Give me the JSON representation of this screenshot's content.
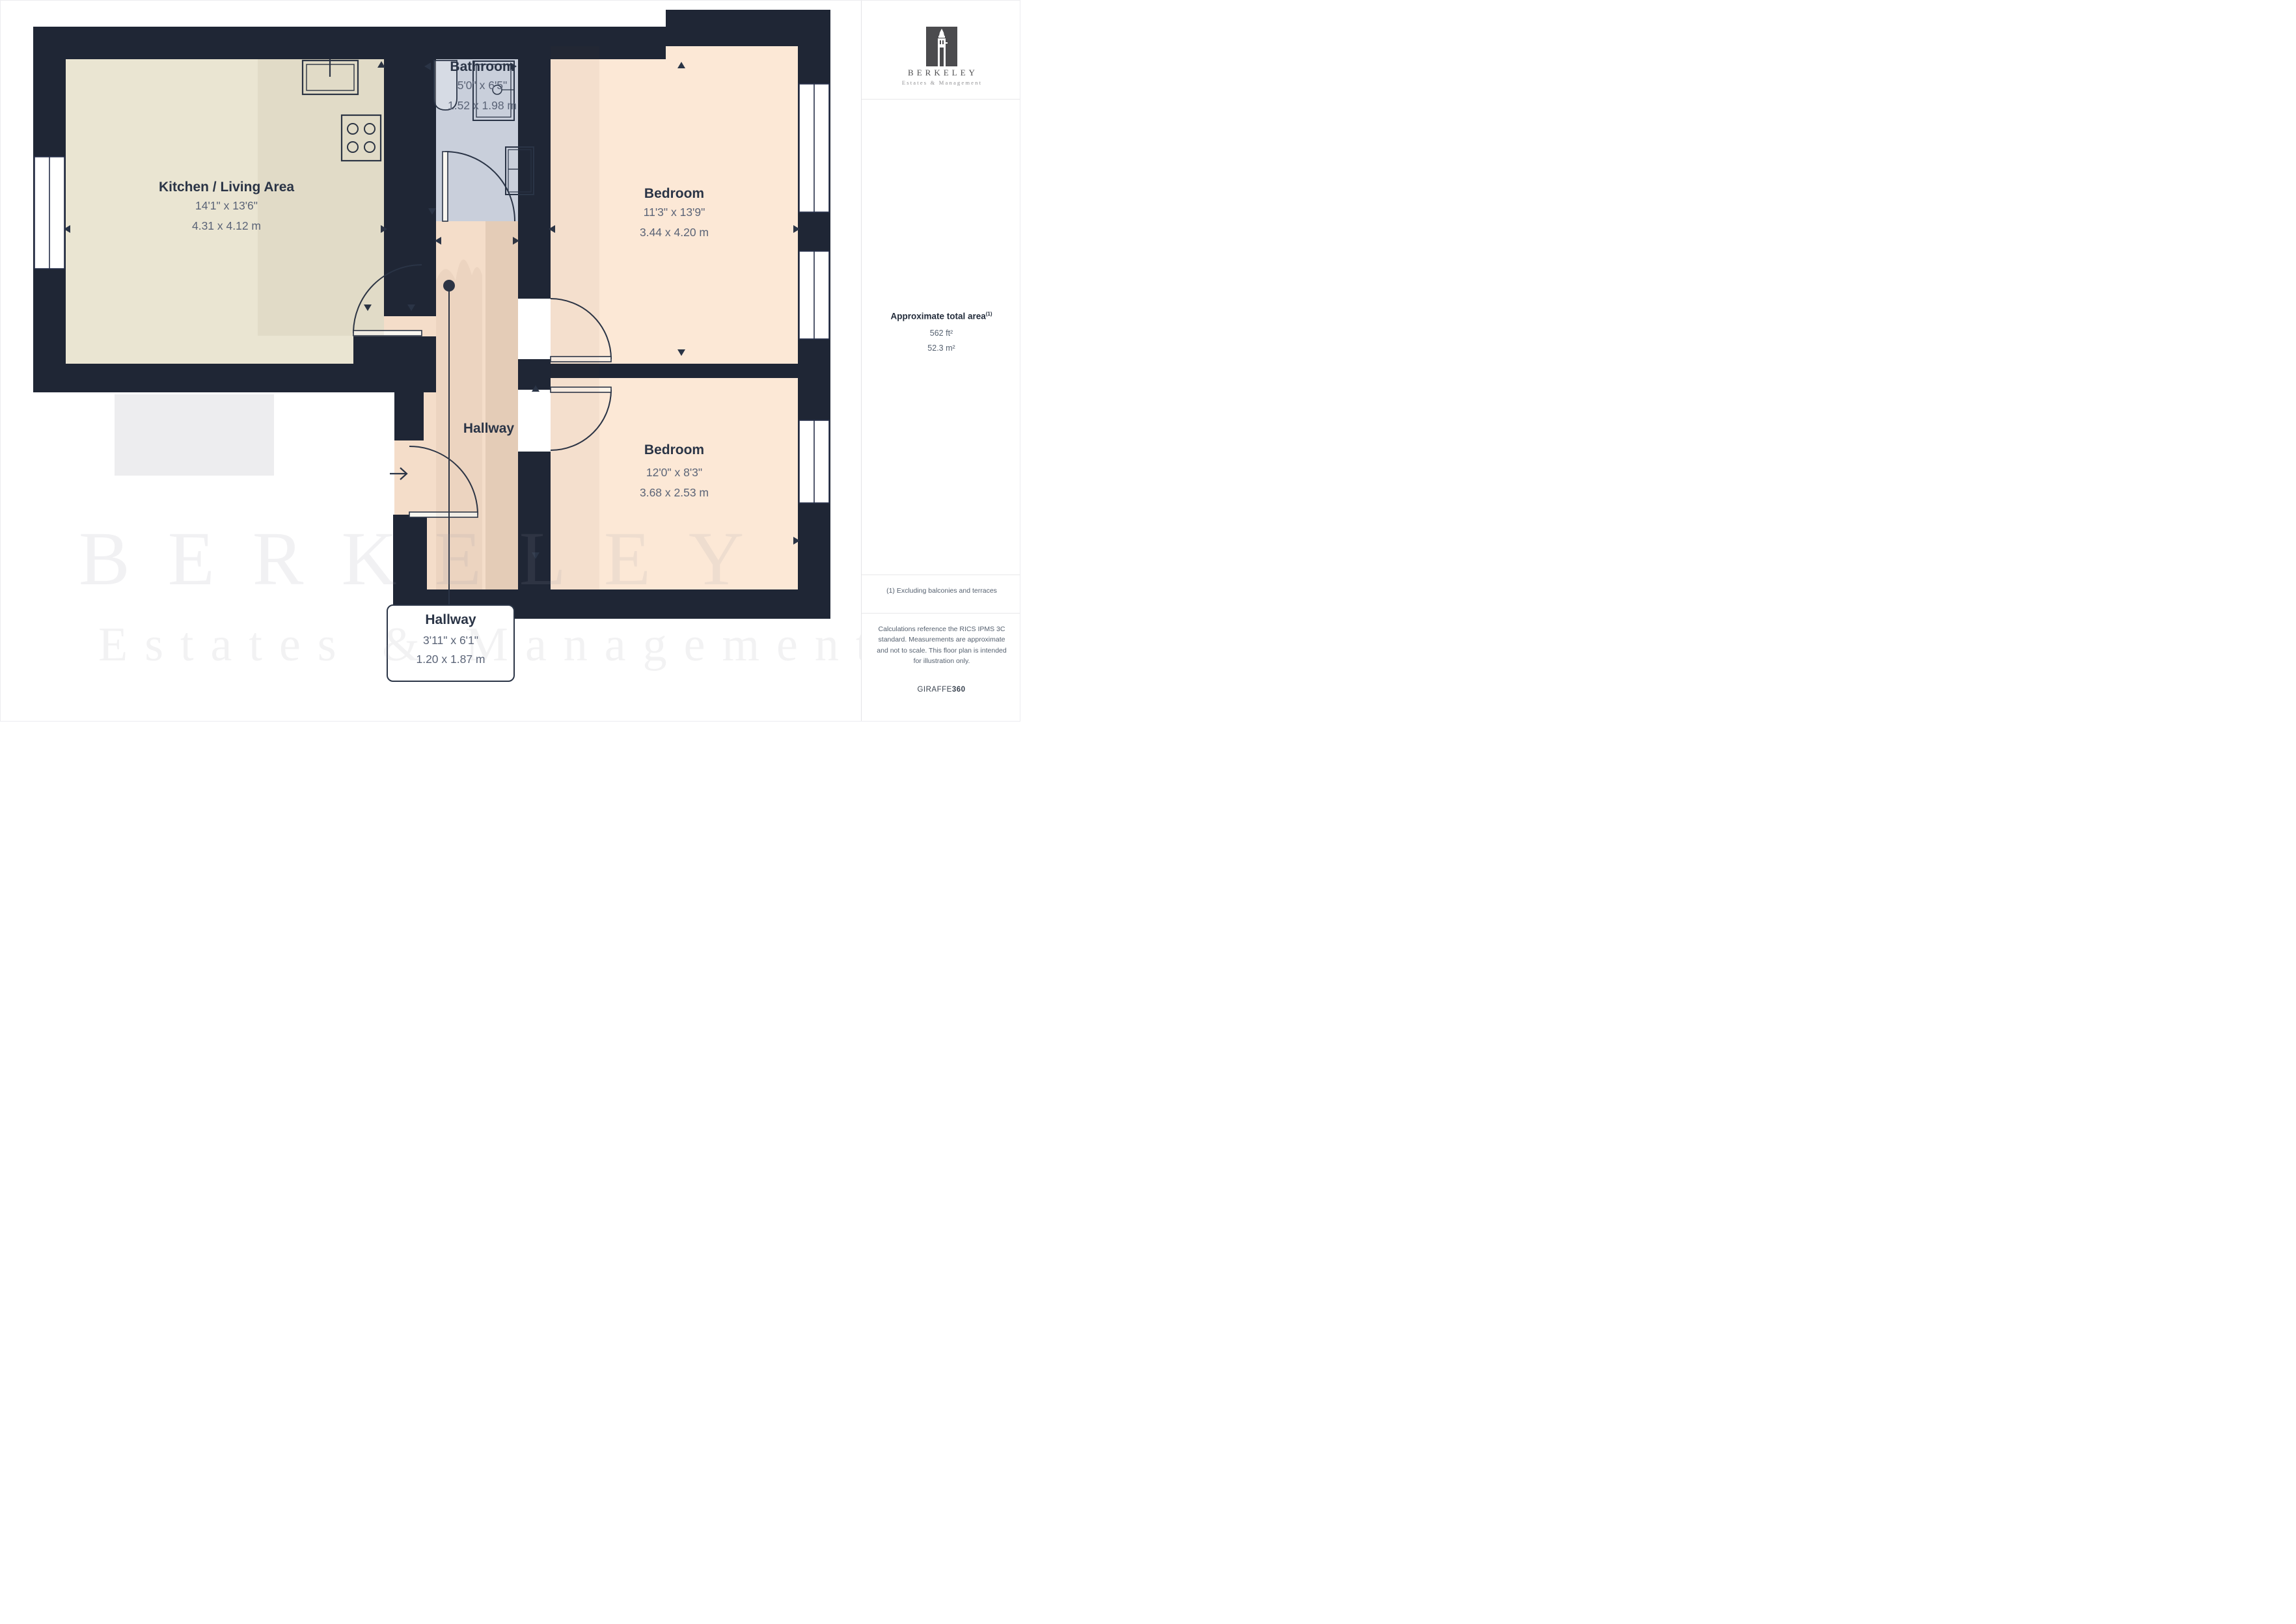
{
  "branding": {
    "name": "BERKELEY",
    "subtitle": "Estates & Management",
    "tower_icon": "clock-tower-icon"
  },
  "sidebar": {
    "area_label": "Approximate total area",
    "area_superscript": "(1)",
    "area_imperial": "562 ft²",
    "area_metric": "52.3 m²",
    "footnote": "(1) Excluding balconies and terraces",
    "disclaimer": "Calculations reference the RICS IPMS 3C standard. Measurements are approximate and not to scale. This floor plan is intended for illustration only.",
    "provider": "GIRAFFE",
    "provider_suffix": "360"
  },
  "rooms": [
    {
      "id": "kitchen-living",
      "name": "Kitchen / Living Area",
      "imperial": "14'1\" x 13'6\"",
      "metric": "4.31 x 4.12 m"
    },
    {
      "id": "bathroom",
      "name": "Bathroom",
      "imperial": "5'0\" x 6'5\"",
      "metric": "1.52 x 1.98 m"
    },
    {
      "id": "bedroom-1",
      "name": "Bedroom",
      "imperial": "11'3\" x 13'9\"",
      "metric": "3.44 x 4.20 m"
    },
    {
      "id": "bedroom-2",
      "name": "Bedroom",
      "imperial": "12'0\" x 8'3\"",
      "metric": "3.68 x 2.53 m"
    },
    {
      "id": "hallway",
      "name": "Hallway",
      "imperial": "3'11\" x 6'1\"",
      "metric": "1.20 x 1.87 m"
    }
  ],
  "watermark": {
    "line1": "BERKELEY",
    "line2": "Estates & Management"
  },
  "colors": {
    "wall": "#1f2635",
    "kitchen_floor": "#eae5d2",
    "bathroom_floor": "#c9cfdb",
    "hallway_floor": "#f4ddc9",
    "bedroom_floor": "#fce8d6",
    "line": "#2a3446"
  }
}
